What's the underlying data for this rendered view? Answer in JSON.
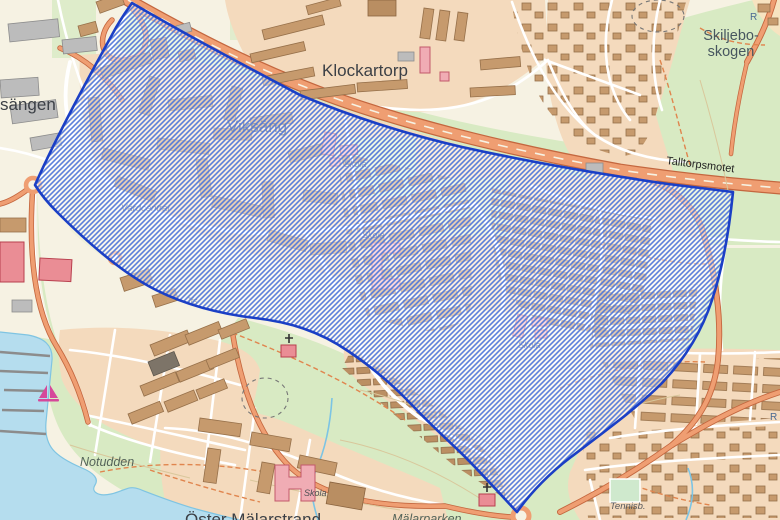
{
  "map": {
    "labels": {
      "district_partial": "sängen",
      "klockartorp": "Klockartorp",
      "viksang": "Viksäng",
      "skiljebo_line1": "Skiljebo-",
      "skiljebo_line2": "skogen",
      "talltorpsmotet": "Talltorpsmotet",
      "vardcentral": "Vårdcentral",
      "skola": "Skola",
      "jfs": "Jfs",
      "notudden": "Notudden",
      "tennis": "Tennisb.",
      "oster_malarstrand": "Öster Mälarstrand",
      "malarparken": "Mälarparken",
      "ancient_monument": "R"
    },
    "colors": {
      "water": "#b5ddee",
      "green": "#d8eac3",
      "residential": "#f4dabd",
      "base_land": "#f6f2e3",
      "building": "#c69a6d",
      "public_building": "#f0acb4",
      "road_major": "#ef9e72",
      "road_minor": "#ffffff",
      "overlay_hatch": "#4a72d8",
      "overlay_border": "#1b3fc5"
    }
  }
}
